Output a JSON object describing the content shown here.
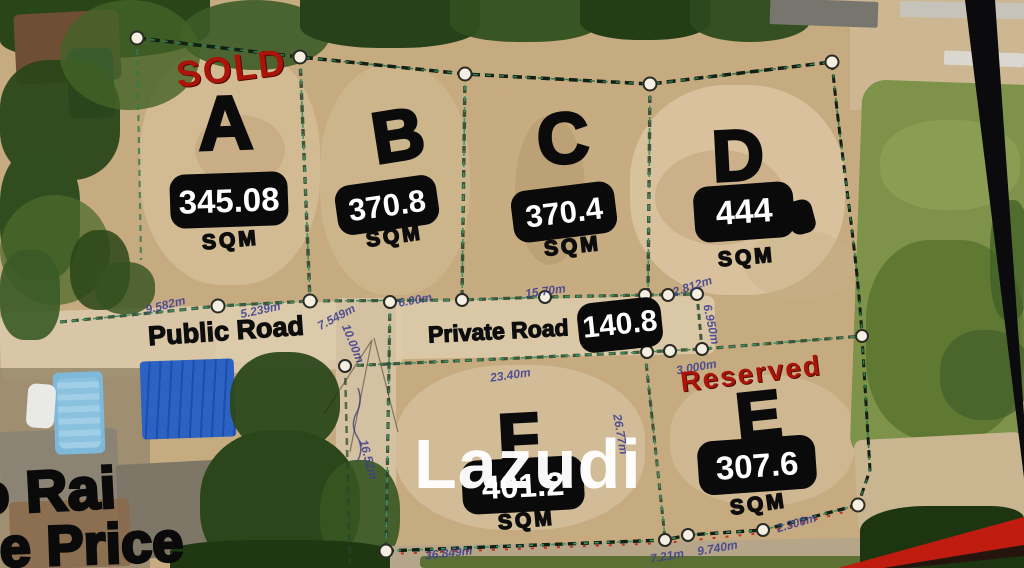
{
  "watermark": "Lazudi",
  "status_labels": {
    "sold": "SOLD",
    "reserved": "Reserved"
  },
  "roads": {
    "public": "Public Road",
    "private": "Private Road",
    "private_length": "140.8"
  },
  "plots": [
    {
      "letter": "A",
      "area": "345.08",
      "unit": "SQM"
    },
    {
      "letter": "B",
      "area": "370.8",
      "unit": "SQM"
    },
    {
      "letter": "C",
      "area": "370.4",
      "unit": "SQM"
    },
    {
      "letter": "D",
      "area": "444",
      "unit": "SQM"
    },
    {
      "letter": "E",
      "area": "307.6",
      "unit": "SQM"
    },
    {
      "letter": "F",
      "area": "401.2",
      "unit": "SQM"
    }
  ],
  "cropped_text": {
    "line1": "o Rai",
    "line2": "le Price"
  },
  "measurements": [
    "9.582m",
    "5.239m",
    "7.549m",
    "10.00m",
    "6.00m",
    "15.70m",
    "2.812m",
    "6.950m",
    "3.000m",
    "23.40m",
    "16.52m",
    "26.77m",
    "36.849m",
    "7.21m",
    "9.740m",
    "2.300m"
  ],
  "colors": {
    "boundary_green": "#2f7a4e",
    "status_red": "#ab1408",
    "measurement_blue": "#3b3d90",
    "label_box_black": "#0a0a0a"
  }
}
